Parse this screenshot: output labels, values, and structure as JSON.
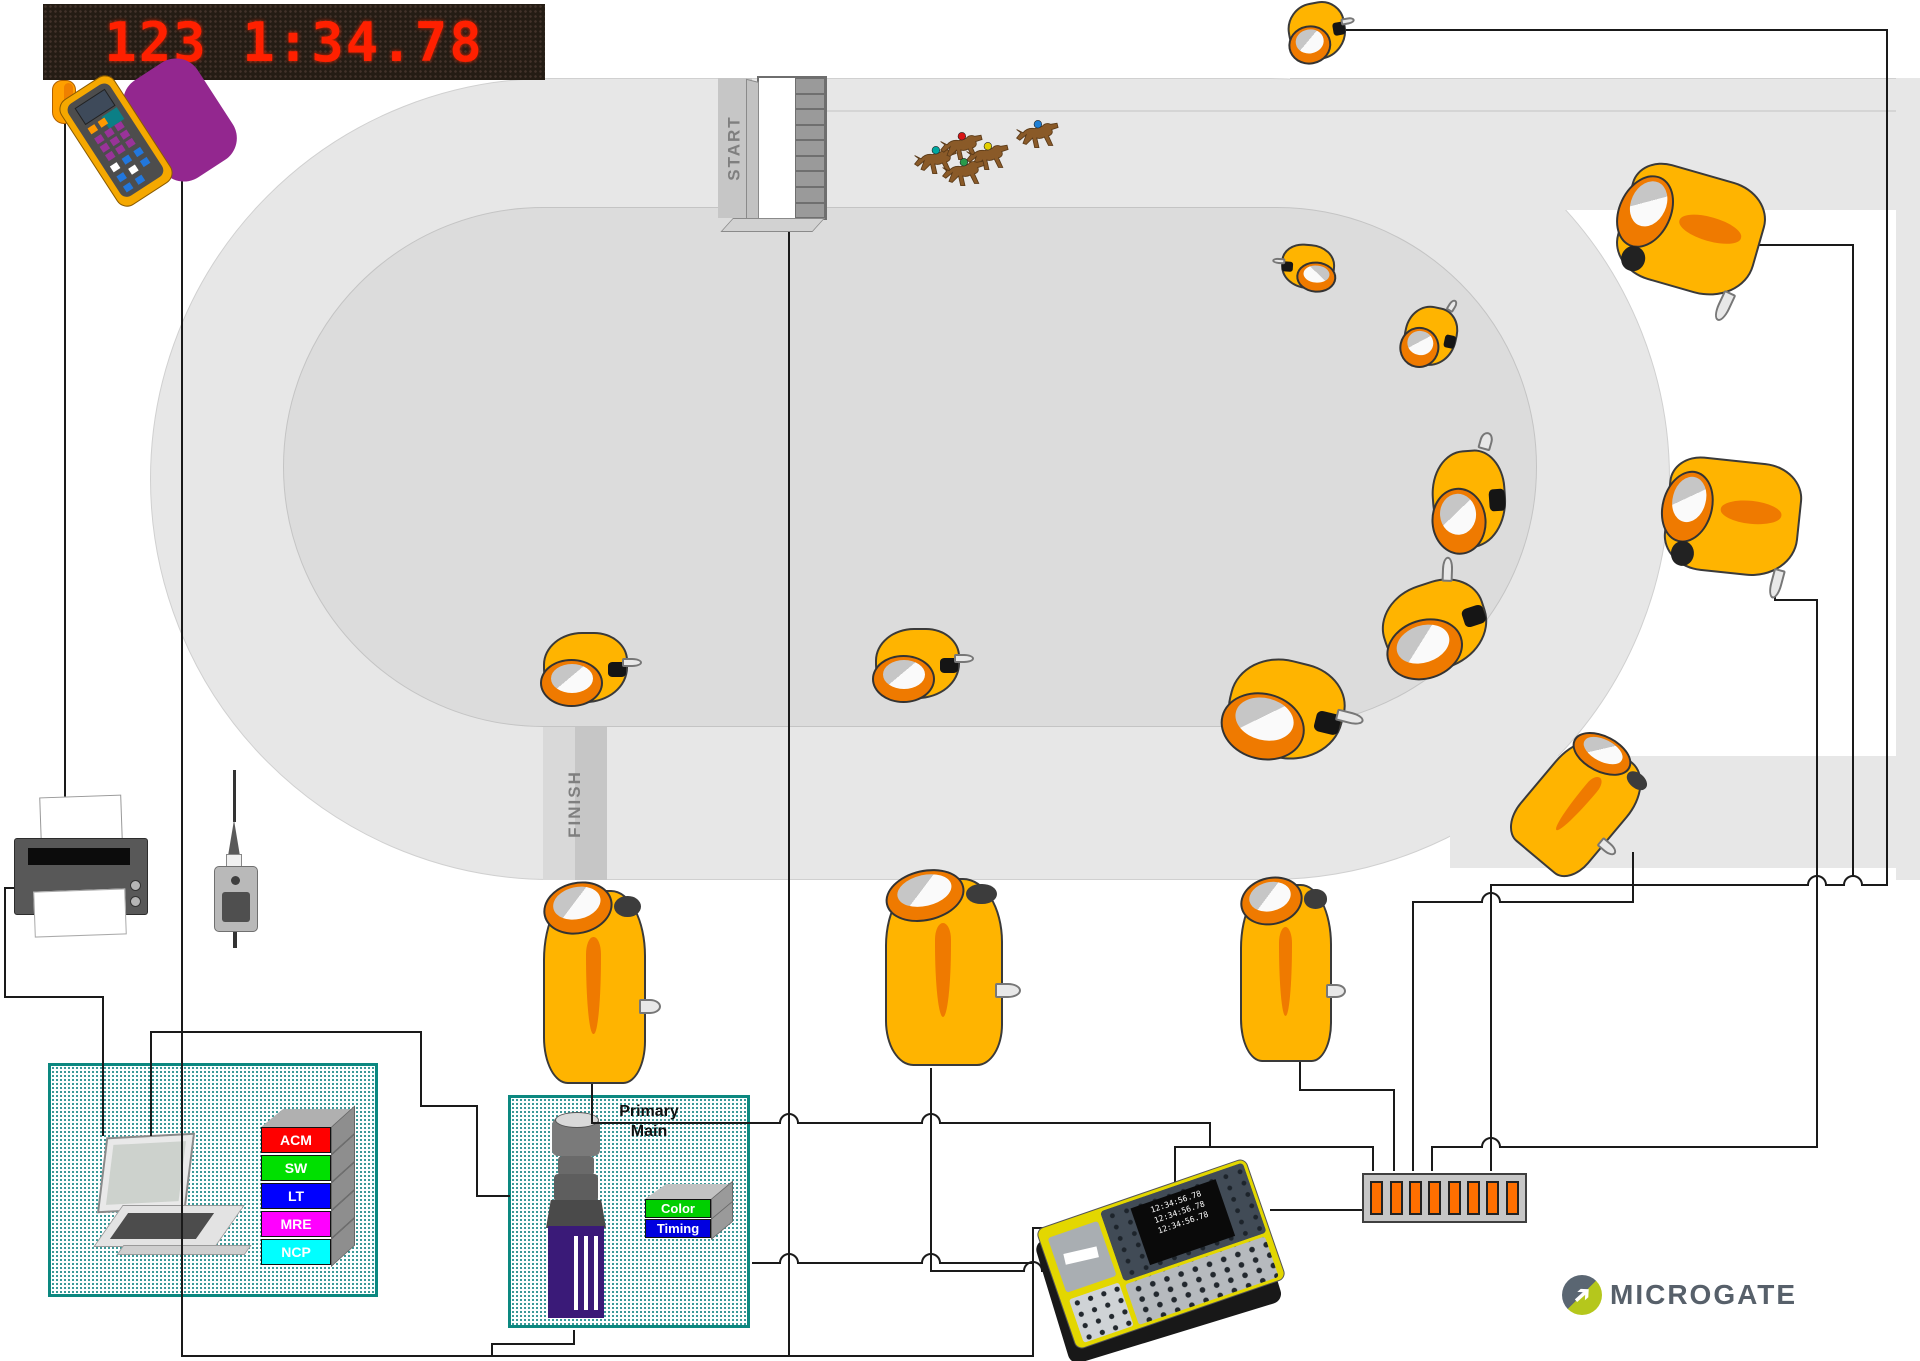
{
  "display_board": {
    "value": "123 1:34.78",
    "led_color": "#ff2000",
    "panel_color": "#241c14"
  },
  "track": {
    "start_label": "START",
    "finish_label": "FINISH",
    "surface_color": "#e7e7e7",
    "infield_color": "#dcdcdc"
  },
  "horses": {
    "count": 5,
    "jockey_colors": [
      "#00a8a0",
      "#d81414",
      "#e3cf00",
      "#2a9a4a",
      "#1f7fd4"
    ]
  },
  "photocells": {
    "count": 14,
    "body_color": "#FFB400",
    "ring_color": "#EF7A00"
  },
  "computer_panel": {
    "modules": [
      {
        "label": "ACM",
        "color": "#ff0000"
      },
      {
        "label": "SW",
        "color": "#00e000"
      },
      {
        "label": "LT",
        "color": "#0000ff"
      },
      {
        "label": "MRE",
        "color": "#ff00ff"
      },
      {
        "label": "NCP",
        "color": "#00ffff"
      }
    ]
  },
  "camera_panel": {
    "title_line1": "Primary",
    "title_line2": "Main",
    "modules": [
      {
        "label": "Color",
        "color": "#00cf00"
      },
      {
        "label": "Timing",
        "color": "#0000e0"
      }
    ]
  },
  "console": {
    "lcd_lines": [
      "12:34:56.78",
      "12:34:56.78",
      "12:34:56.78"
    ]
  },
  "distribution_box": {
    "slot_count": 8,
    "slot_color": "#ff6f00"
  },
  "brand": {
    "name": "MICROGATE",
    "text_color": "#57606a",
    "circle_top_color": "#5a6672",
    "circle_bottom_color": "#b5c71c"
  }
}
